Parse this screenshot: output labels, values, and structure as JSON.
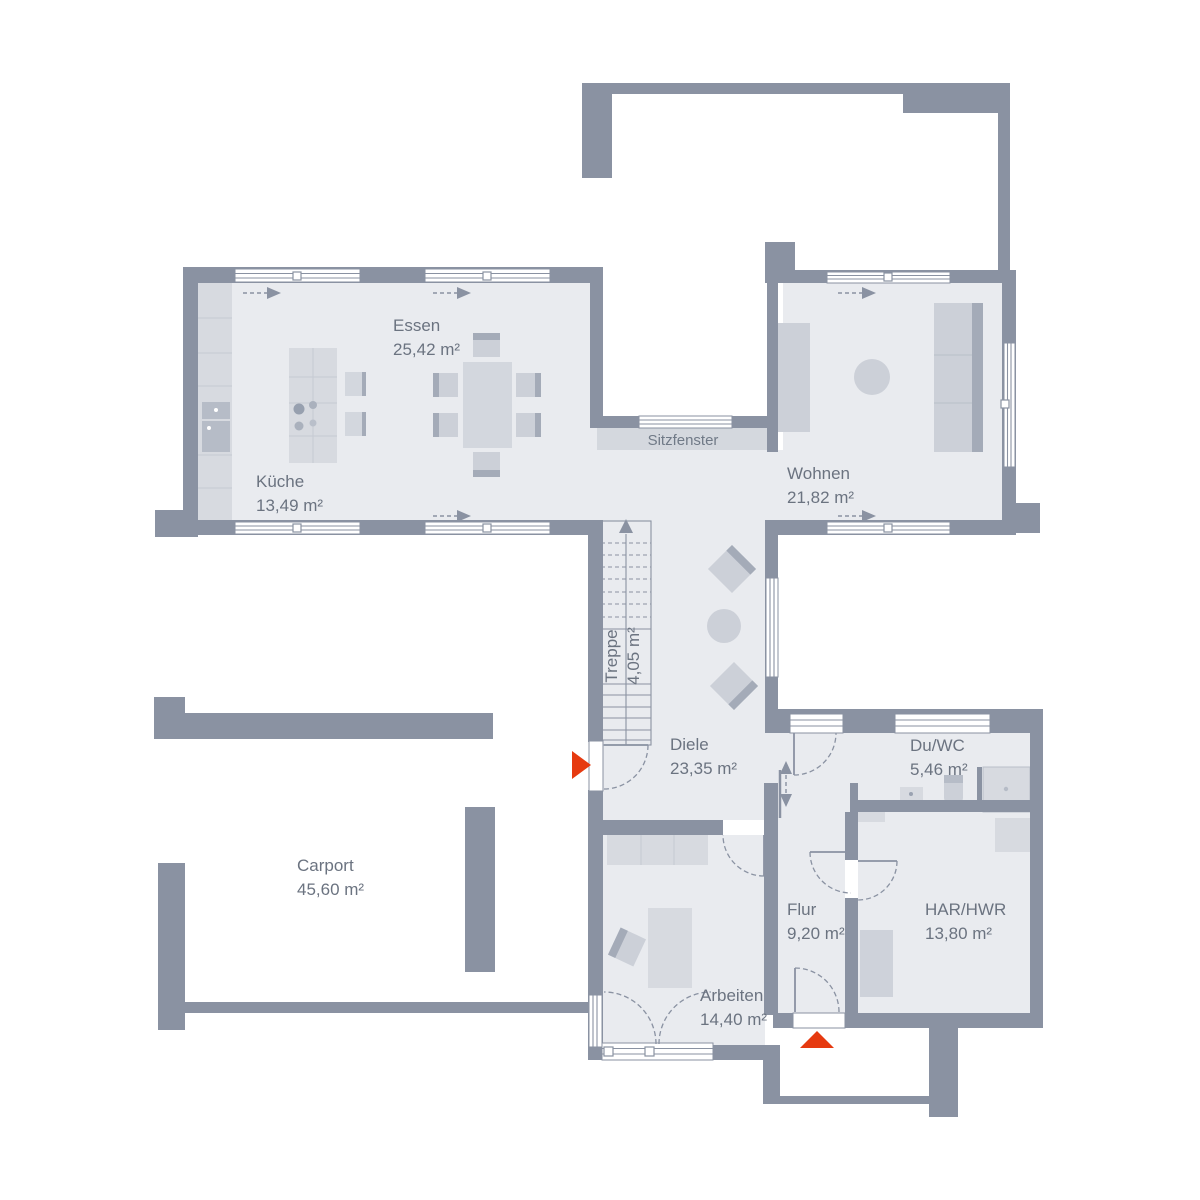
{
  "plan": {
    "rooms": [
      {
        "id": "essen",
        "name": "Essen",
        "area": "25,42 m²"
      },
      {
        "id": "kueche",
        "name": "Küche",
        "area": "13,49 m²"
      },
      {
        "id": "wohnen",
        "name": "Wohnen",
        "area": "21,82 m²"
      },
      {
        "id": "treppe",
        "name": "Treppe",
        "area": "4,05 m²"
      },
      {
        "id": "diele",
        "name": "Diele",
        "area": "23,35 m²"
      },
      {
        "id": "carport",
        "name": "Carport",
        "area": "45,60 m²"
      },
      {
        "id": "arbeiten",
        "name": "Arbeiten",
        "area": "14,40 m²"
      },
      {
        "id": "flur",
        "name": "Flur",
        "area": "9,20 m²"
      },
      {
        "id": "du_wc",
        "name": "Du/WC",
        "area": "5,46 m²"
      },
      {
        "id": "har_hwr",
        "name": "HAR/HWR",
        "area": "13,80 m²"
      }
    ],
    "labels": {
      "sitzfenster": "Sitzfenster"
    },
    "icons": {
      "entry_side": "red-triangle-pointing-right",
      "entry_front": "red-triangle-pointing-up",
      "stair_direction": "arrow-up",
      "window_opening": "dashed-arrow-right",
      "sliding_door": "double-arrow-vertical"
    },
    "colors": {
      "wall": "#8a92a2",
      "floor": "#e9ebef",
      "furniture": "#d3d7de",
      "furniture_dark": "#a4abb8",
      "window": "#ffffff",
      "accent_red": "#e63a10",
      "text": "#6b7380",
      "background": "#ffffff"
    }
  }
}
